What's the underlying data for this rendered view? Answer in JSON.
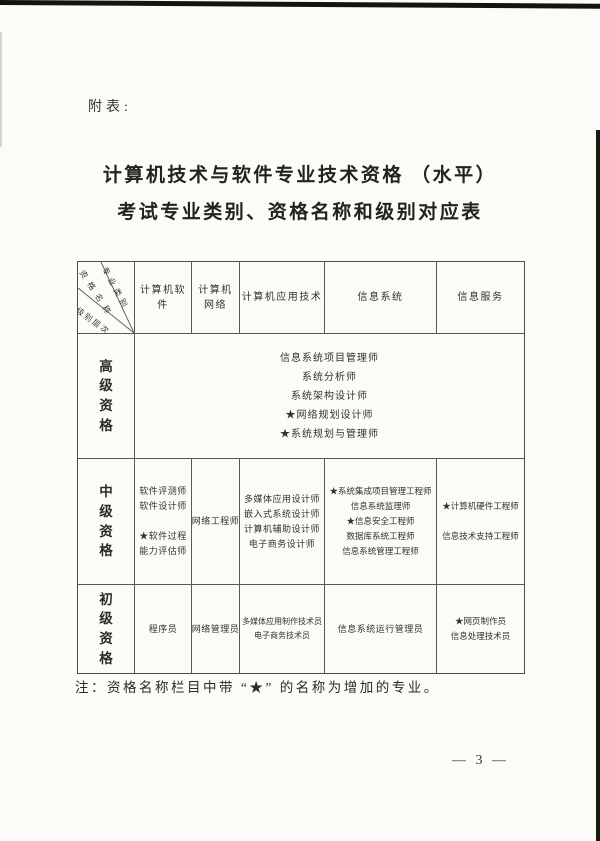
{
  "page": {
    "attachment_label": "附表:",
    "title_line1": "计算机技术与软件专业技术资格 （水平）",
    "title_line2": "考试专业类别、资格名称和级别对应表",
    "note": "注：资格名称栏目中带 “★” 的名称为增加的专业。",
    "page_number": "— 3 —"
  },
  "table": {
    "corner": {
      "top_label": "专业类别",
      "middle_label": "资格名称",
      "bottom_label": "级别层次"
    },
    "columns": {
      "software": "计算机软件",
      "network": "计算机\n网络",
      "application": "计算机应用技术",
      "system": "信息系统",
      "service": "信息服务"
    },
    "rows": {
      "senior": {
        "level": "高级资格",
        "items": [
          "信息系统项目管理师",
          "系统分析师",
          "系统架构设计师",
          "★网络规划设计师",
          "★系统规划与管理师"
        ]
      },
      "middle": {
        "level": "中级资格",
        "software": [
          "软件评测师",
          "软件设计师",
          "",
          "★软件过程",
          "能力评估师"
        ],
        "network": [
          "网络工程师"
        ],
        "application": [
          "多媒体应用设计师",
          "嵌入式系统设计师",
          "计算机辅助设计师",
          "电子商务设计师"
        ],
        "system": [
          "★系统集成项目管理工程师",
          "信息系统监理师",
          "★信息安全工程师",
          "数据库系统工程师",
          "信息系统管理工程师"
        ],
        "service": [
          "★计算机硬件工程师",
          "",
          "信息技术支持工程师"
        ]
      },
      "junior": {
        "level": "初级资格",
        "software": [
          "程序员"
        ],
        "network": [
          "网络管理员"
        ],
        "application": [
          "多媒体应用制作技术员",
          "电子商务技术员"
        ],
        "system": [
          "信息系统运行管理员"
        ],
        "service": [
          "★网页制作员",
          "信息处理技术员"
        ]
      }
    }
  }
}
